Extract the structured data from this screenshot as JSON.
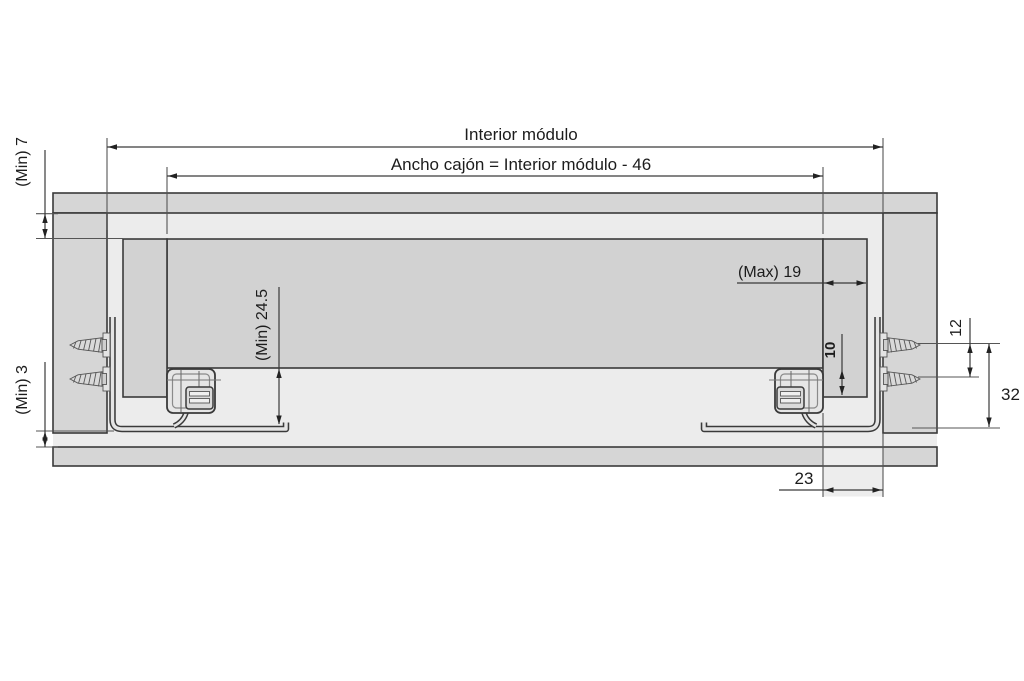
{
  "canvas": {
    "background": "#ffffff"
  },
  "colors": {
    "line": "#3a3a3a",
    "thin_line": "#777777",
    "panel_fill": "#d6d6d6",
    "interior_fill": "#ececec",
    "drawer_fill": "#d2d2d2",
    "hardware_fill": "#e4e4e4",
    "clip_fill": "#dadada",
    "cutout_fill": "#ededed",
    "text": "#1c1c1c"
  },
  "labels": {
    "interior_modulo": "Interior módulo",
    "ancho_cajon": "Ancho cajón = Interior módulo - 46",
    "min_7": "(Min) 7",
    "min_3": "(Min) 3",
    "min_24_5": "(Min) 24.5",
    "max_19": "(Max) 19",
    "dim_10": "10",
    "dim_12": "12",
    "dim_32": "32",
    "dim_23": "23"
  }
}
